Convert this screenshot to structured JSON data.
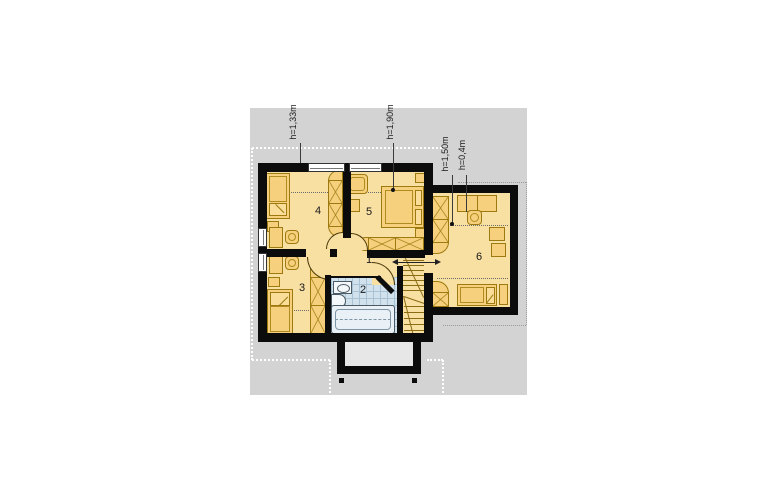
{
  "plan": {
    "title": "attic floor plan",
    "rooms": [
      {
        "id": "hall",
        "label": "1"
      },
      {
        "id": "bathroom",
        "label": "2"
      },
      {
        "id": "bedroom-3",
        "label": "3"
      },
      {
        "id": "bedroom-4",
        "label": "4"
      },
      {
        "id": "bedroom-5",
        "label": "5"
      },
      {
        "id": "bedroom-6",
        "label": "6"
      }
    ],
    "height_annotations": [
      {
        "text": "h=1,33m"
      },
      {
        "text": "h=1,90m"
      },
      {
        "text": "h=1,50m"
      },
      {
        "text": "h=0,4m"
      }
    ],
    "colors": {
      "plot_gray": "#d3d3d3",
      "wall_black": "#0c0c0c",
      "room_fill": "#f8dfa2",
      "furniture_fill": "#f6d07c",
      "furniture_line": "#9c7a10",
      "bathroom_tile": "#d2e2ed",
      "bathroom_grid": "#a9c2d4",
      "roof_outline": "#ffffff"
    }
  }
}
